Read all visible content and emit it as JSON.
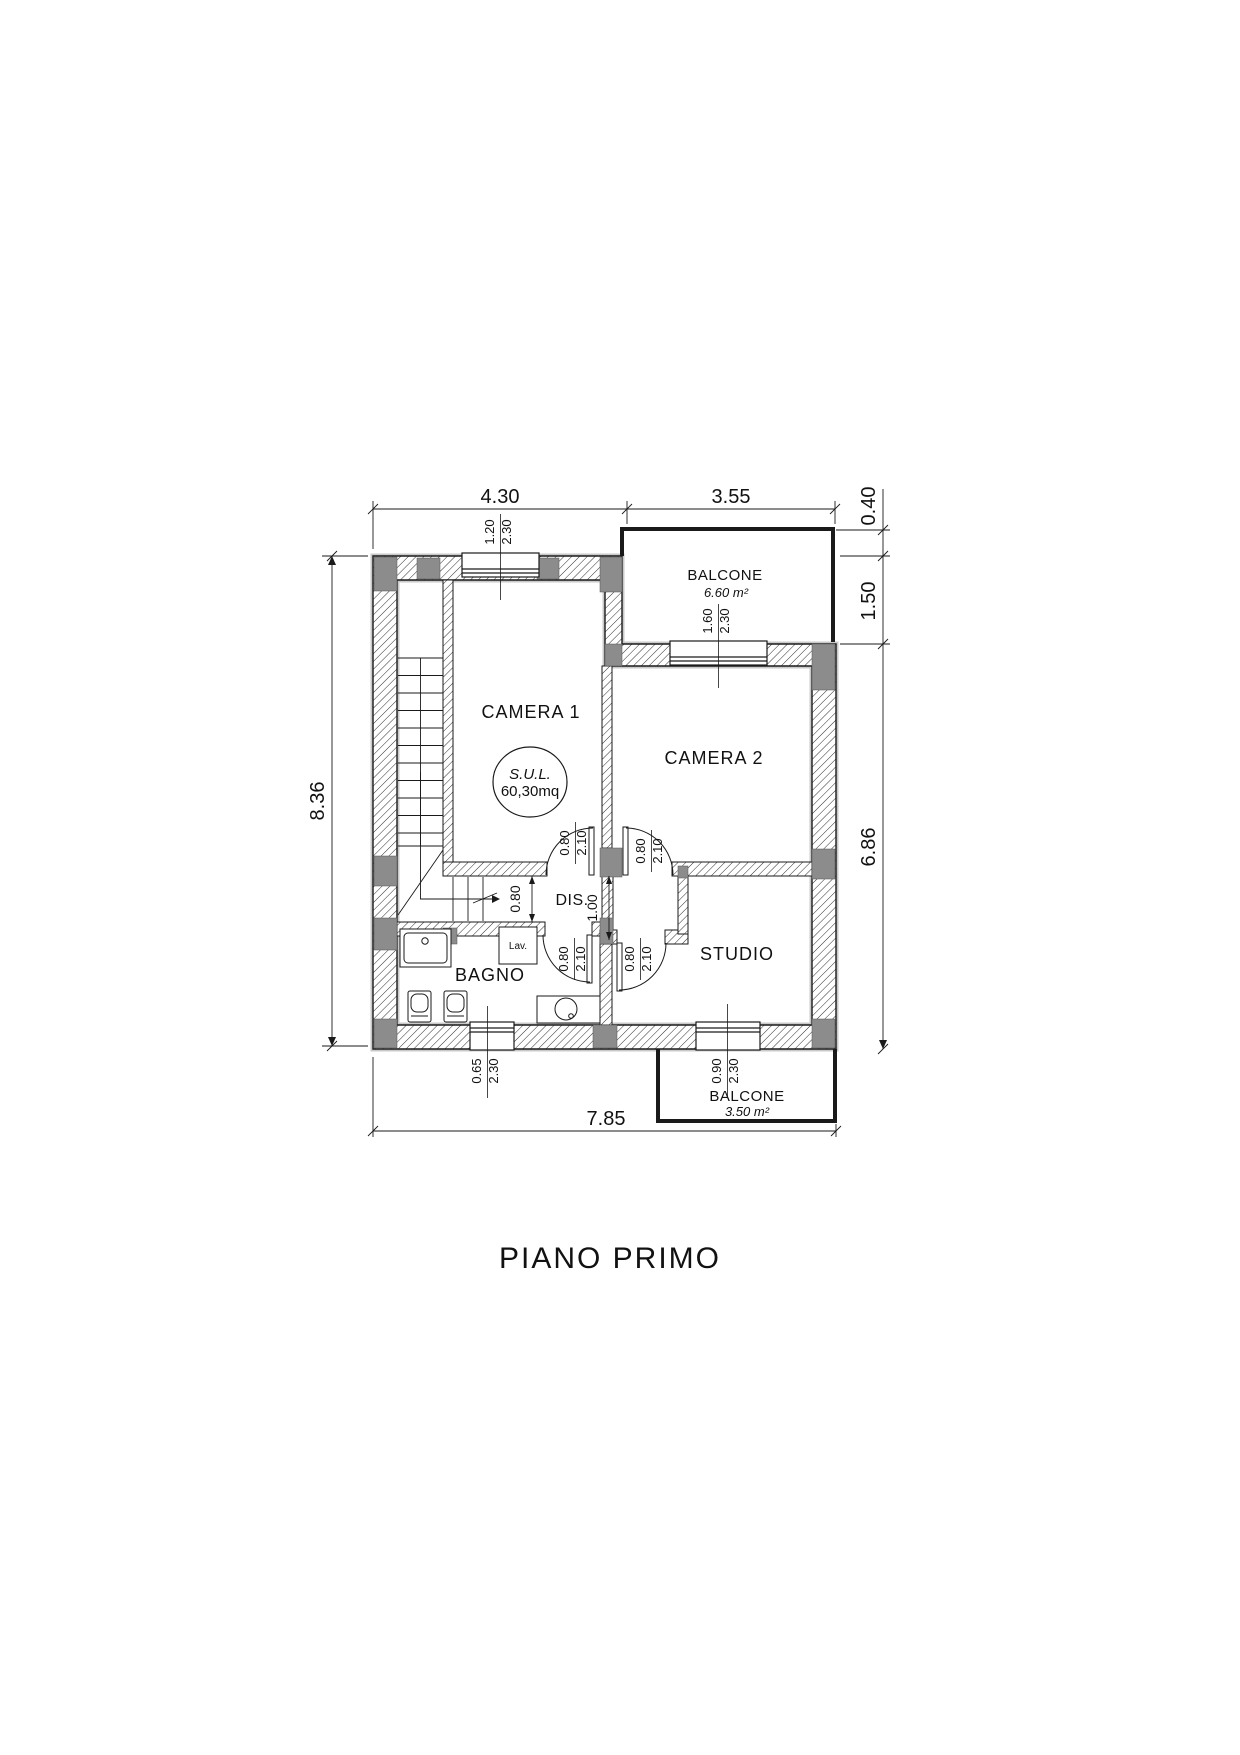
{
  "title": "PIANO PRIMO",
  "plan": {
    "rooms": {
      "camera1": "CAMERA 1",
      "camera2": "CAMERA 2",
      "bagno": "BAGNO",
      "studio": "STUDIO",
      "dis": "DIS.",
      "lav": "Lav."
    },
    "balconies": {
      "top": {
        "label": "BALCONE",
        "area": "6.60 m²"
      },
      "bottom": {
        "label": "BALCONE",
        "area": "3.50 m²"
      }
    },
    "sul": {
      "label": "S.U.L.",
      "value": "60,30mq"
    },
    "dims": {
      "top_left": "4.30",
      "top_right": "3.55",
      "right_top": "0.40",
      "right_mid": "1.50",
      "right_main": "6.86",
      "left_total": "8.36",
      "bottom_total": "7.85",
      "dis_height": "0.80",
      "dis_width": "1.00"
    },
    "windows": {
      "camera1": {
        "w": "1.20",
        "h": "2.30"
      },
      "camera2": {
        "w": "1.60",
        "h": "2.30"
      },
      "bagno": {
        "w": "0.65",
        "h": "2.30"
      },
      "studio": {
        "w": "0.90",
        "h": "2.30"
      }
    },
    "doors": {
      "camera1": {
        "w": "0.80",
        "h": "2.10"
      },
      "camera2": {
        "w": "0.80",
        "h": "2.10"
      },
      "bagno": {
        "w": "0.80",
        "h": "2.10"
      },
      "studio": {
        "w": "0.80",
        "h": "2.10"
      }
    },
    "colors": {
      "line": "#1a1a1a",
      "pier": "#8c8c8c",
      "halo": "#c9c9c9"
    }
  }
}
